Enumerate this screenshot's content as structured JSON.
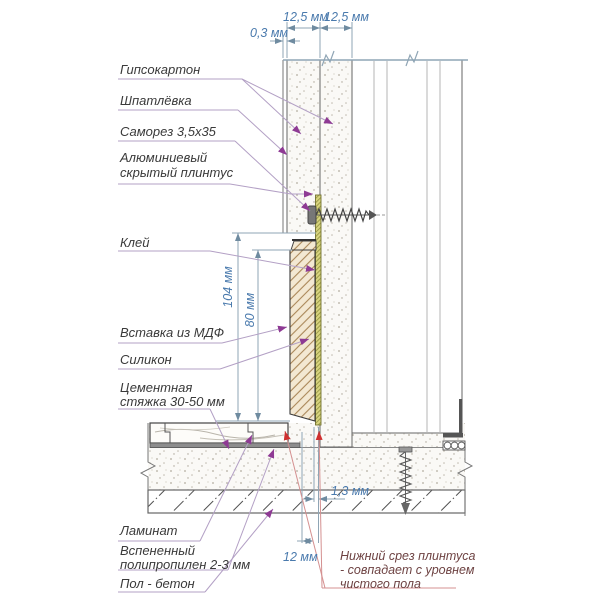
{
  "diagram": {
    "labels": {
      "gypsum_board": "Гипсокартон",
      "putty": "Шпатлёвка",
      "self_tapping_screw": "Саморез 3,5x35",
      "aluminum_hidden_plinth": "Алюминиевый скрытый плинтус",
      "glue": "Клей",
      "mdf_insert": "Вставка из МДФ",
      "silicone": "Силикон",
      "cement_screed": "Цементная стяжка 30-50 мм",
      "laminate": "Ламинат",
      "foamed_polypropylene": "Вспененный полипропилен 2-3 мм",
      "concrete_floor": "Пол - бетон",
      "bottom_cut_note": "Нижний срез плинтуса - совпадает с уровнем чистого пола"
    },
    "dimensions": {
      "putty_thickness": "0,3 мм",
      "gypsum_sheet_1": "12,5 мм",
      "gypsum_sheet_2": "12,5 мм",
      "plinth_profile_height": "104 мм",
      "insert_visible_height": "80 мм",
      "bottom_gap": "1,3 мм",
      "plinth_depth": "12 мм"
    },
    "colors": {
      "dimension_text": "#4a7aad",
      "dimension_line": "#8fa5b5",
      "leader_line": "#b3a0c5",
      "leader_arrow": "#8e3a94",
      "label_text": "#3a3a3a",
      "note_text": "#6e4343",
      "note_leader": "#d49090",
      "note_arrow": "#cf3030"
    }
  }
}
